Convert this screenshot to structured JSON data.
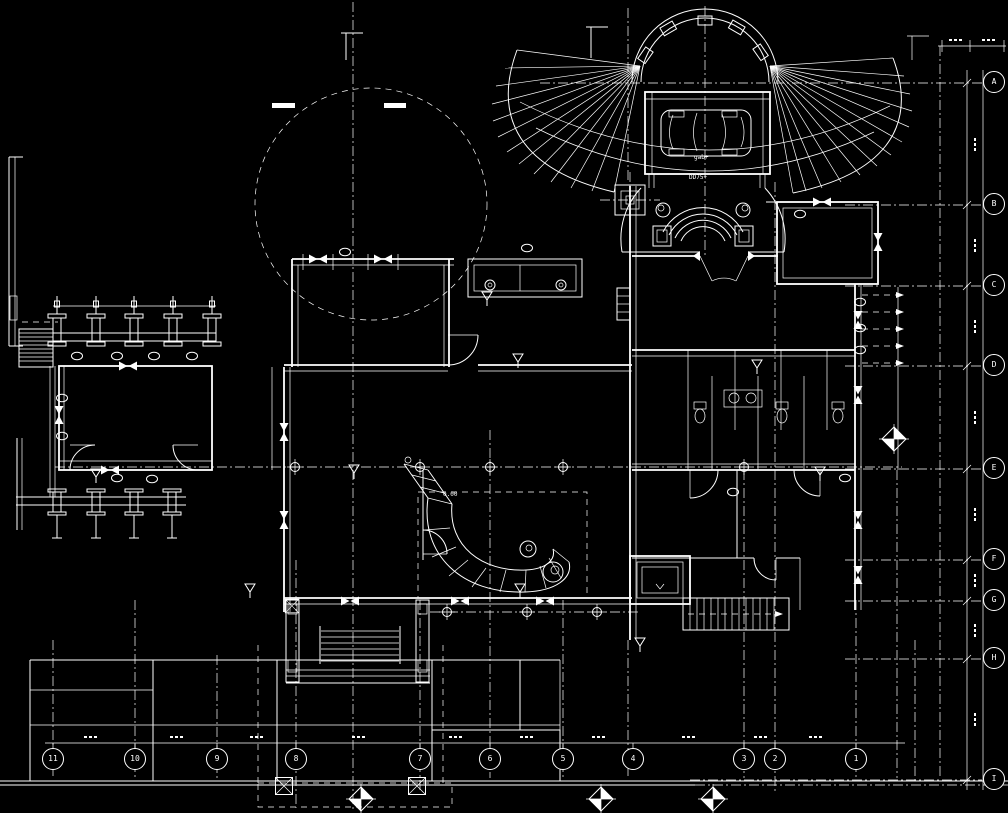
{
  "drawing": {
    "kind_label": "cad-floor-plan",
    "background_color": "#000000",
    "line_color": "#ffffff"
  },
  "grid": {
    "bottom_axis": {
      "bubbles": [
        {
          "label": "11"
        },
        {
          "label": "10"
        },
        {
          "label": "9"
        },
        {
          "label": "8"
        },
        {
          "label": "7"
        },
        {
          "label": "6"
        },
        {
          "label": "5"
        },
        {
          "label": "4"
        },
        {
          "label": "3"
        },
        {
          "label": "2"
        },
        {
          "label": "1"
        }
      ]
    },
    "right_axis": {
      "bubbles": [
        {
          "label": "A"
        },
        {
          "label": "B"
        },
        {
          "label": "C"
        },
        {
          "label": "D"
        },
        {
          "label": "E"
        },
        {
          "label": "F"
        },
        {
          "label": "G"
        },
        {
          "label": "H"
        },
        {
          "label": "I"
        }
      ]
    }
  },
  "annotations": {
    "items": [
      {
        "text": "gab+"
      },
      {
        "text": "DD75+"
      },
      {
        "text": "0.00"
      }
    ]
  }
}
